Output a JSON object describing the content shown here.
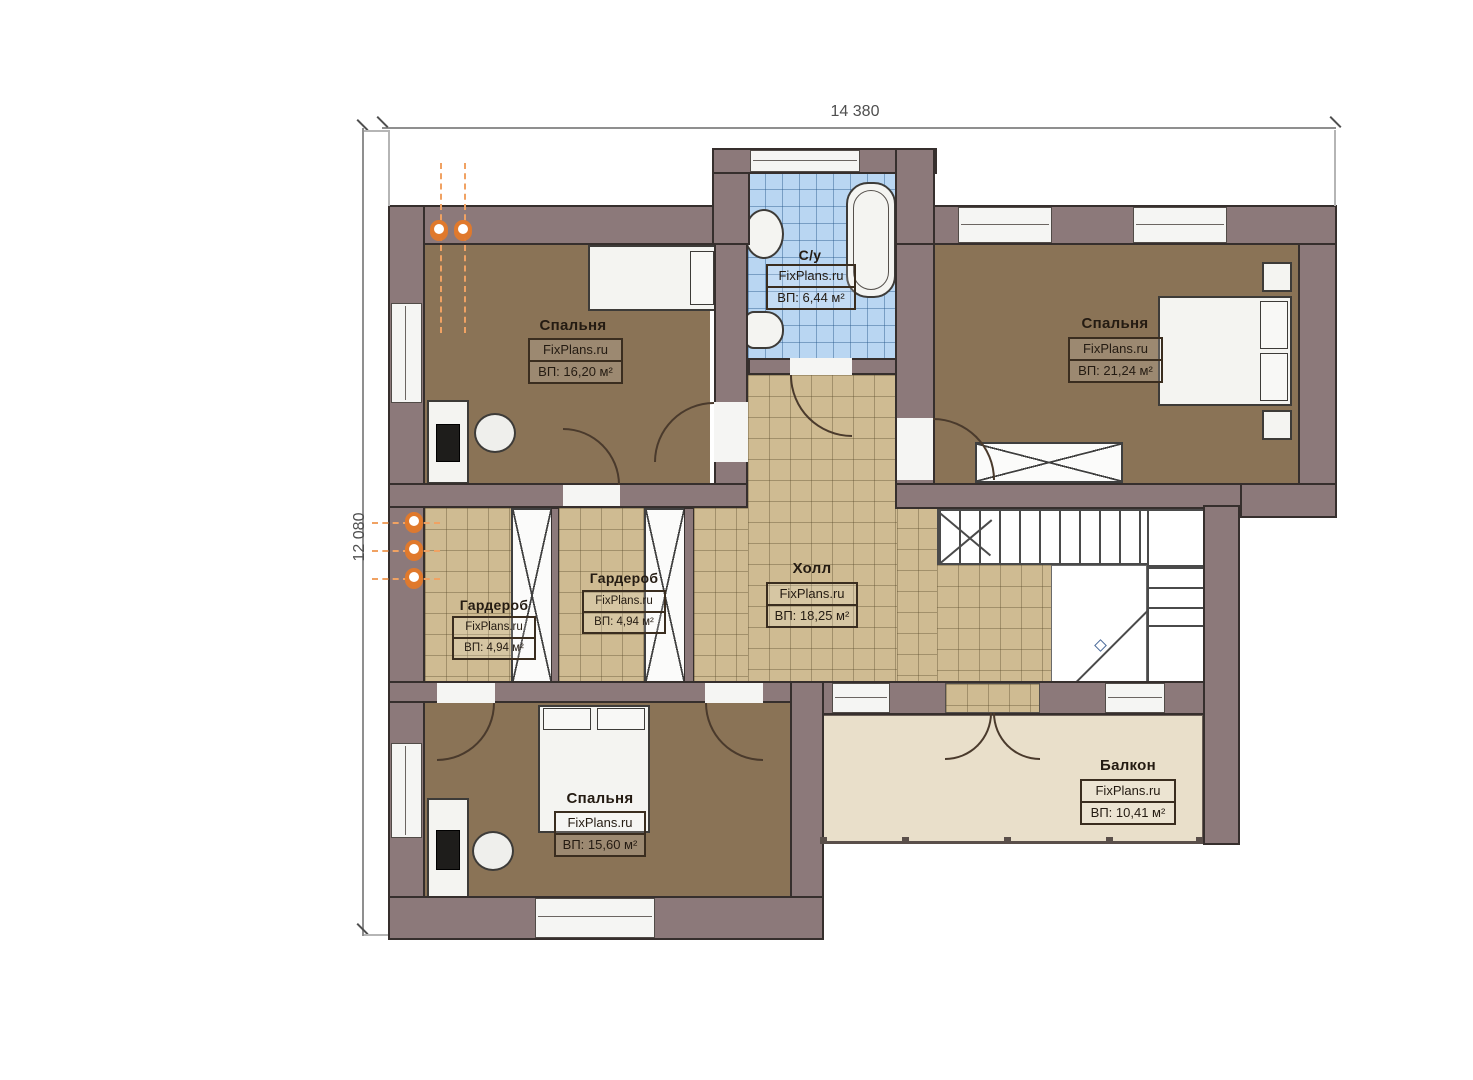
{
  "dimensions": {
    "width_label": "14 380",
    "height_label": "12 080"
  },
  "rooms": [
    {
      "id": "bedroom-top-left",
      "name": "Спальня",
      "brand": "FixPlans.ru",
      "area": "ВП: 16,20 м²"
    },
    {
      "id": "bathroom",
      "name": "С/у",
      "brand": "FixPlans.ru",
      "area": "ВП: 6,44 м²"
    },
    {
      "id": "bedroom-top-right",
      "name": "Спальня",
      "brand": "FixPlans.ru",
      "area": "ВП: 21,24 м²"
    },
    {
      "id": "wardrobe-left",
      "name": "Гардероб",
      "brand": "FixPlans.ru",
      "area": "ВП: 4,94 м²"
    },
    {
      "id": "wardrobe-middle",
      "name": "Гардероб",
      "brand": "FixPlans.ru",
      "area": "ВП: 4,94 м²"
    },
    {
      "id": "hall",
      "name": "Холл",
      "brand": "FixPlans.ru",
      "area": "ВП: 18,25 м²"
    },
    {
      "id": "bedroom-bottom",
      "name": "Спальня",
      "brand": "FixPlans.ru",
      "area": "ВП: 15,60 м²"
    },
    {
      "id": "balcony",
      "name": "Балкон",
      "brand": "FixPlans.ru",
      "area": "ВП: 10,41 м²"
    }
  ],
  "colors": {
    "wall": "#8c797a",
    "wall_outline": "#362f2d",
    "floor_wood": "#8a7356",
    "tile_beige": "#cfbb92",
    "tile_blue": "#b9d6f2",
    "balcony_floor": "#e9dfca",
    "radiator_orange": "#e0792c"
  }
}
